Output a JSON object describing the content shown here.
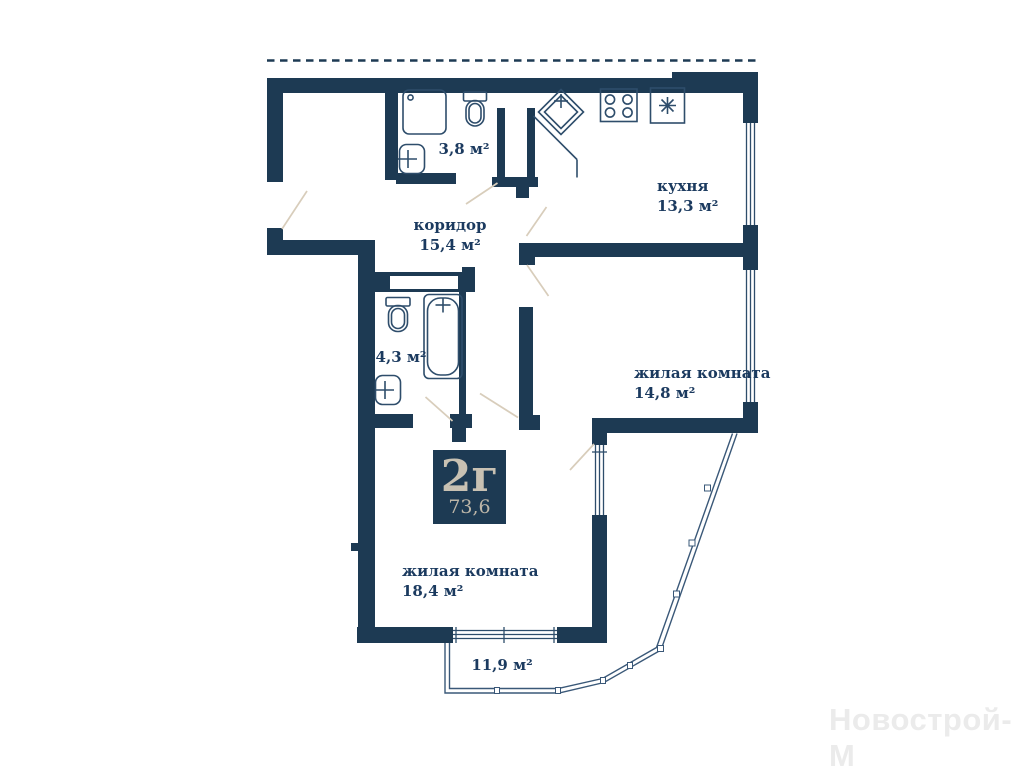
{
  "plan": {
    "badge": {
      "layout_code": "2г",
      "total_area": "73,6"
    },
    "rooms": {
      "kitchen": {
        "name": "кухня",
        "area": "13,3 м²"
      },
      "corridor": {
        "name": "коридор",
        "area": "15,4 м²"
      },
      "bathroom_small": {
        "area": "3,8 м²"
      },
      "bathroom_big": {
        "area": "4,3 м²"
      },
      "living_room_right": {
        "name": "жилая комната",
        "area": "14,8 м²"
      },
      "living_room_bottom": {
        "name": "жилая комната",
        "area": "18,4 м²"
      },
      "balcony": {
        "area": "11,9 м²"
      }
    },
    "watermark": "Новострой-М",
    "colors": {
      "wall": "#1d3a53",
      "label_text": "#1b3a5f",
      "badge_bg": "#1d3a53",
      "badge_text": "#c8c1b3",
      "fixture_stroke": "#2e4d6b",
      "door_arc": "#d8cdbb",
      "balcony_stroke": "#3a5878"
    }
  }
}
